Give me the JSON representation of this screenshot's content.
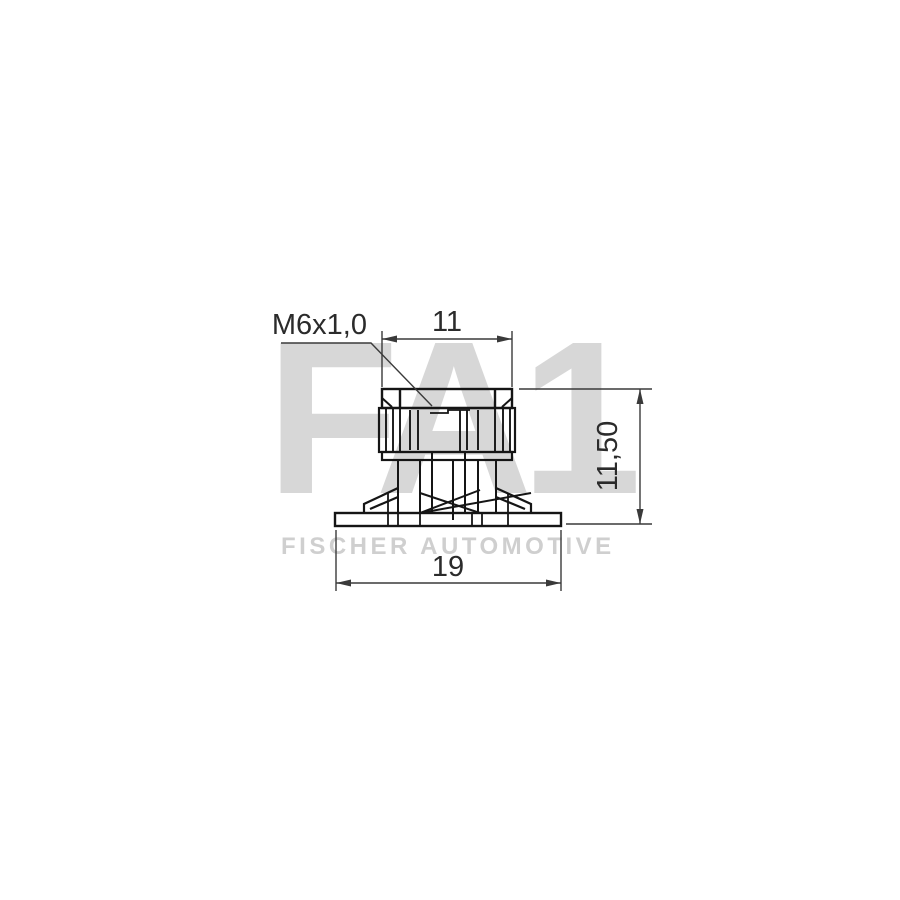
{
  "drawing": {
    "type": "technical-part-drawing",
    "part": "flange cage nut, side elevation view",
    "dimensions": {
      "thread_label": "M6x1,0",
      "top_width": "11",
      "right_height": "11,50",
      "bottom_width": "19"
    },
    "watermark": {
      "logo": "FA1",
      "brand": "FISCHER AUTOMOTIVE"
    },
    "colors": {
      "background": "#ffffff",
      "part_line": "#151515",
      "dimension_line": "#3a3a3a",
      "dimension_text": "#2b2b2b",
      "watermark_logo": "#d7d7d7",
      "watermark_brand": "#cfcfcf"
    }
  }
}
